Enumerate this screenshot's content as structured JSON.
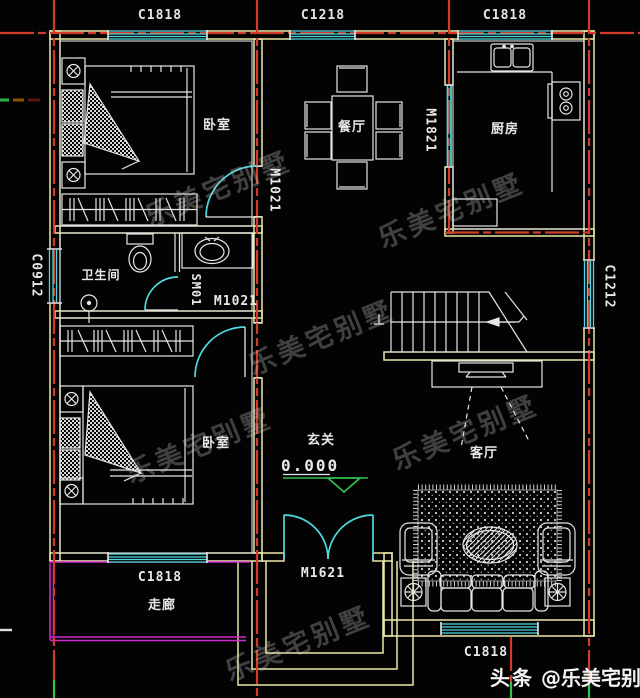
{
  "labels": {
    "windows": {
      "top_left": "C1818",
      "top_center": "C1218",
      "top_right": "C1818",
      "left_wall": "C0912",
      "right_wall": "C1212",
      "bottom_left": "C1818",
      "living_room": "C1818"
    },
    "doors": {
      "bedroom1": "M1021",
      "bedroom2": "M1021",
      "kitchen": "M1821",
      "entrance": "M1621",
      "shower": "SM01"
    },
    "rooms": {
      "bedroom1": "卧室",
      "bedroom2": "卧室",
      "dining": "餐厅",
      "kitchen": "厨房",
      "bathroom": "卫生间",
      "living": "客厅",
      "foyer": "玄关",
      "corridor": "走廊"
    },
    "elevation": "0.000",
    "watermark": "乐美宅别墅",
    "credit": {
      "prefix": "头条",
      "handle": "@乐美宅别墅"
    }
  },
  "colors": {
    "wall": "#ece7a8",
    "centerline": "#d23b28",
    "window": "#4fd8e0",
    "corridor": "#cf2ccf",
    "elevation": "#31c249",
    "furniture": "#e6e6e6",
    "background": "#030303"
  }
}
